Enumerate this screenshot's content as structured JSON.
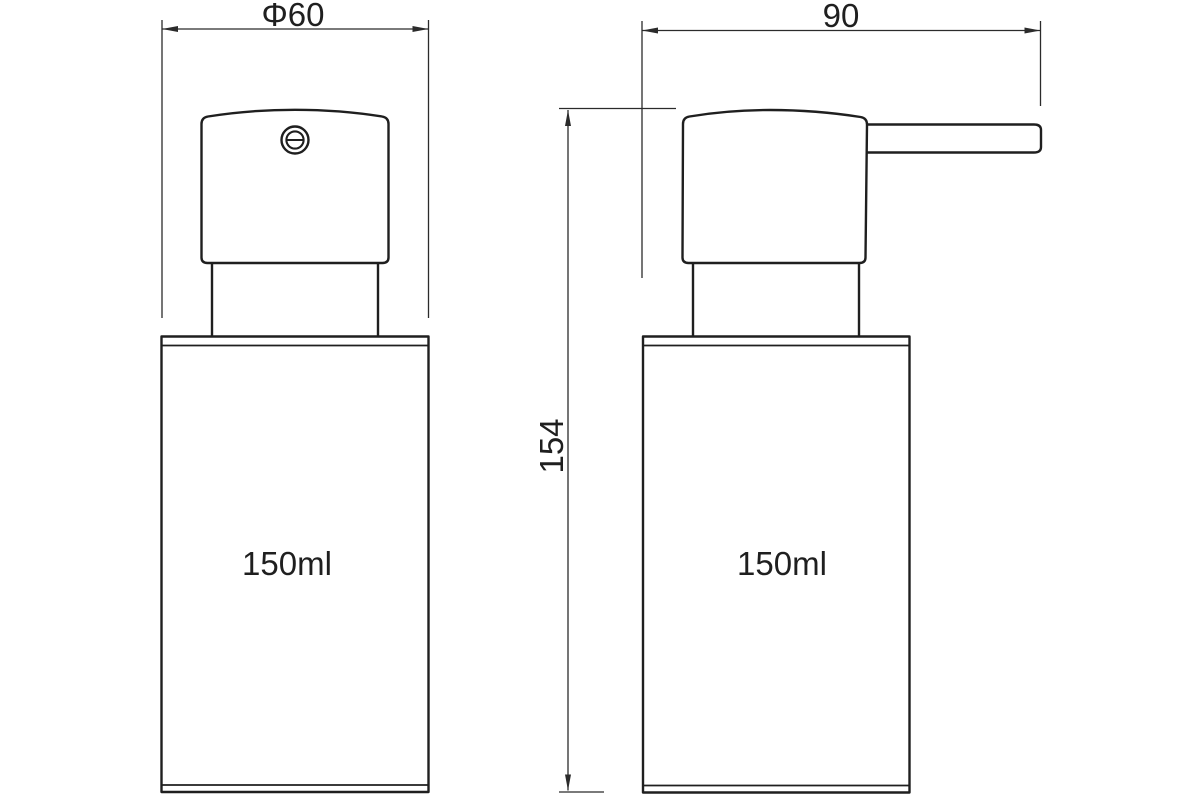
{
  "drawing": {
    "description": "technical line drawing of a soap dispenser pump bottle, front view and side view",
    "views": {
      "front": {
        "volume_label": "150ml"
      },
      "side": {
        "volume_label": "150ml"
      }
    },
    "dimensions": {
      "diameter": {
        "label": "Φ60",
        "value": 60
      },
      "depth": {
        "label": "90",
        "value": 90
      },
      "height": {
        "label": "154",
        "value": 154
      }
    }
  },
  "colors": {
    "background": "#ffffff",
    "line": "#1f1f1f",
    "dim": "#2b2b2b"
  }
}
